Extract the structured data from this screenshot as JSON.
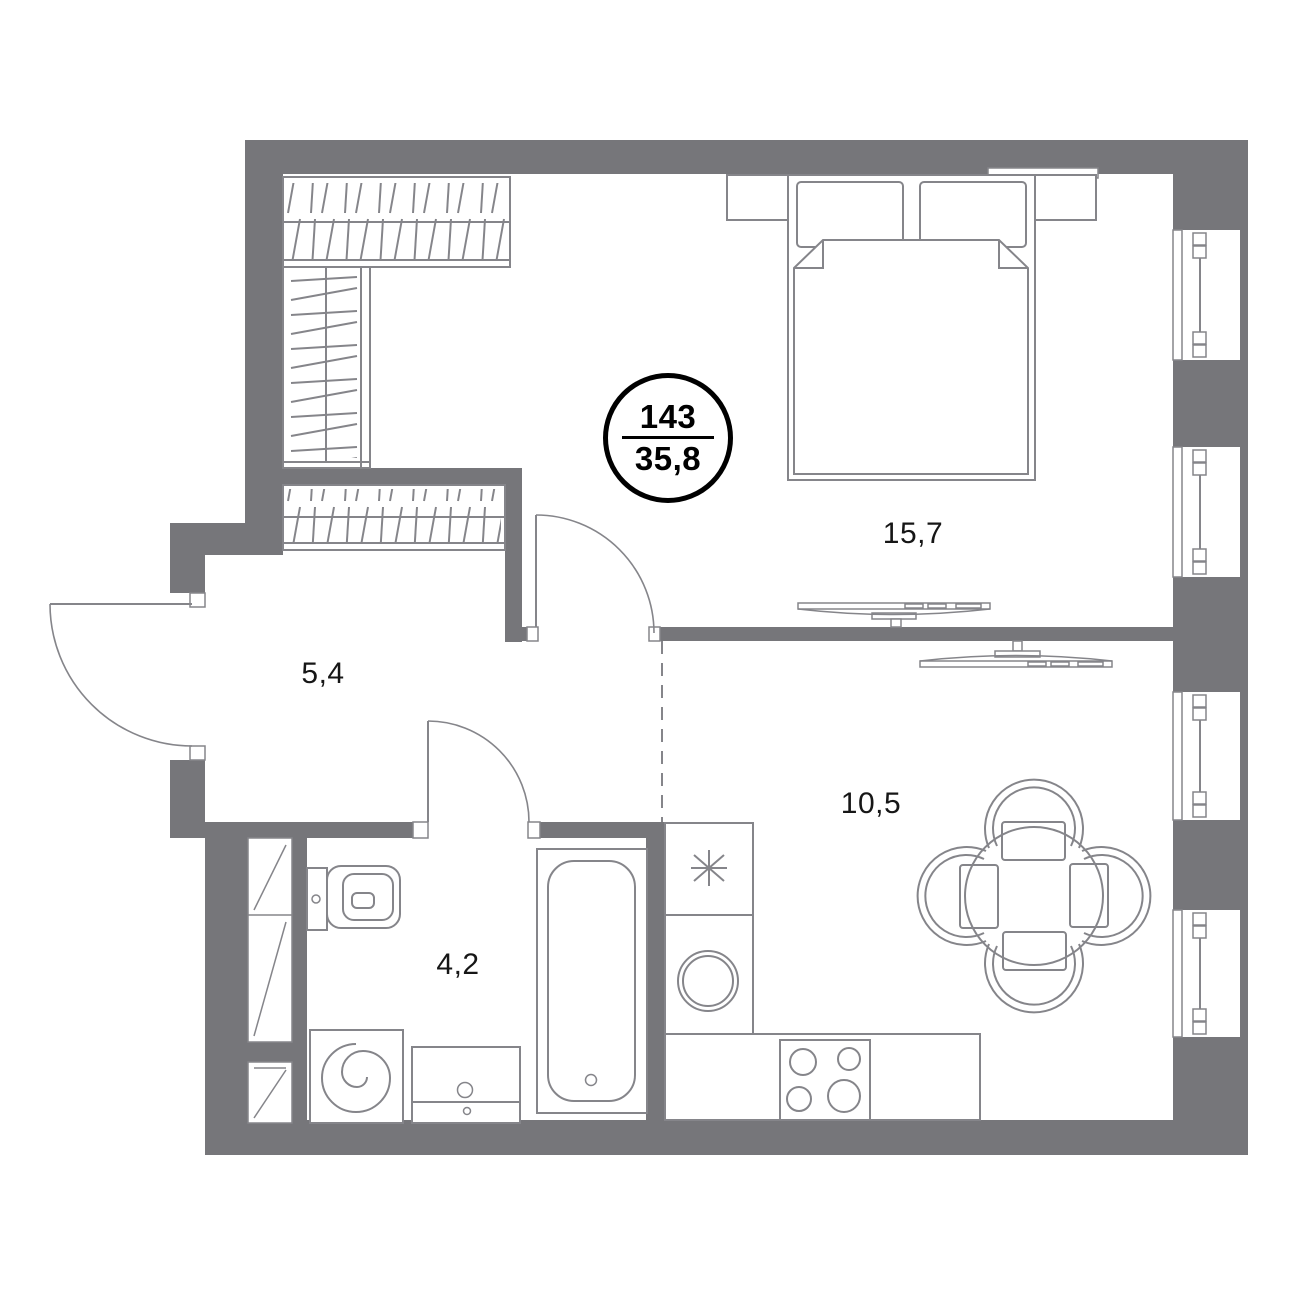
{
  "unit_badge": {
    "number": "143",
    "total_area": "35,8"
  },
  "room_labels": {
    "bedroom": "15,7",
    "hallway": "5,4",
    "bathroom": "4,2",
    "kitchen_living": "10,5"
  },
  "colors": {
    "wall": "#76767a",
    "furniture_line": "#85858a",
    "text": "#161616",
    "badge_border": "#000000",
    "background": "#ffffff"
  }
}
